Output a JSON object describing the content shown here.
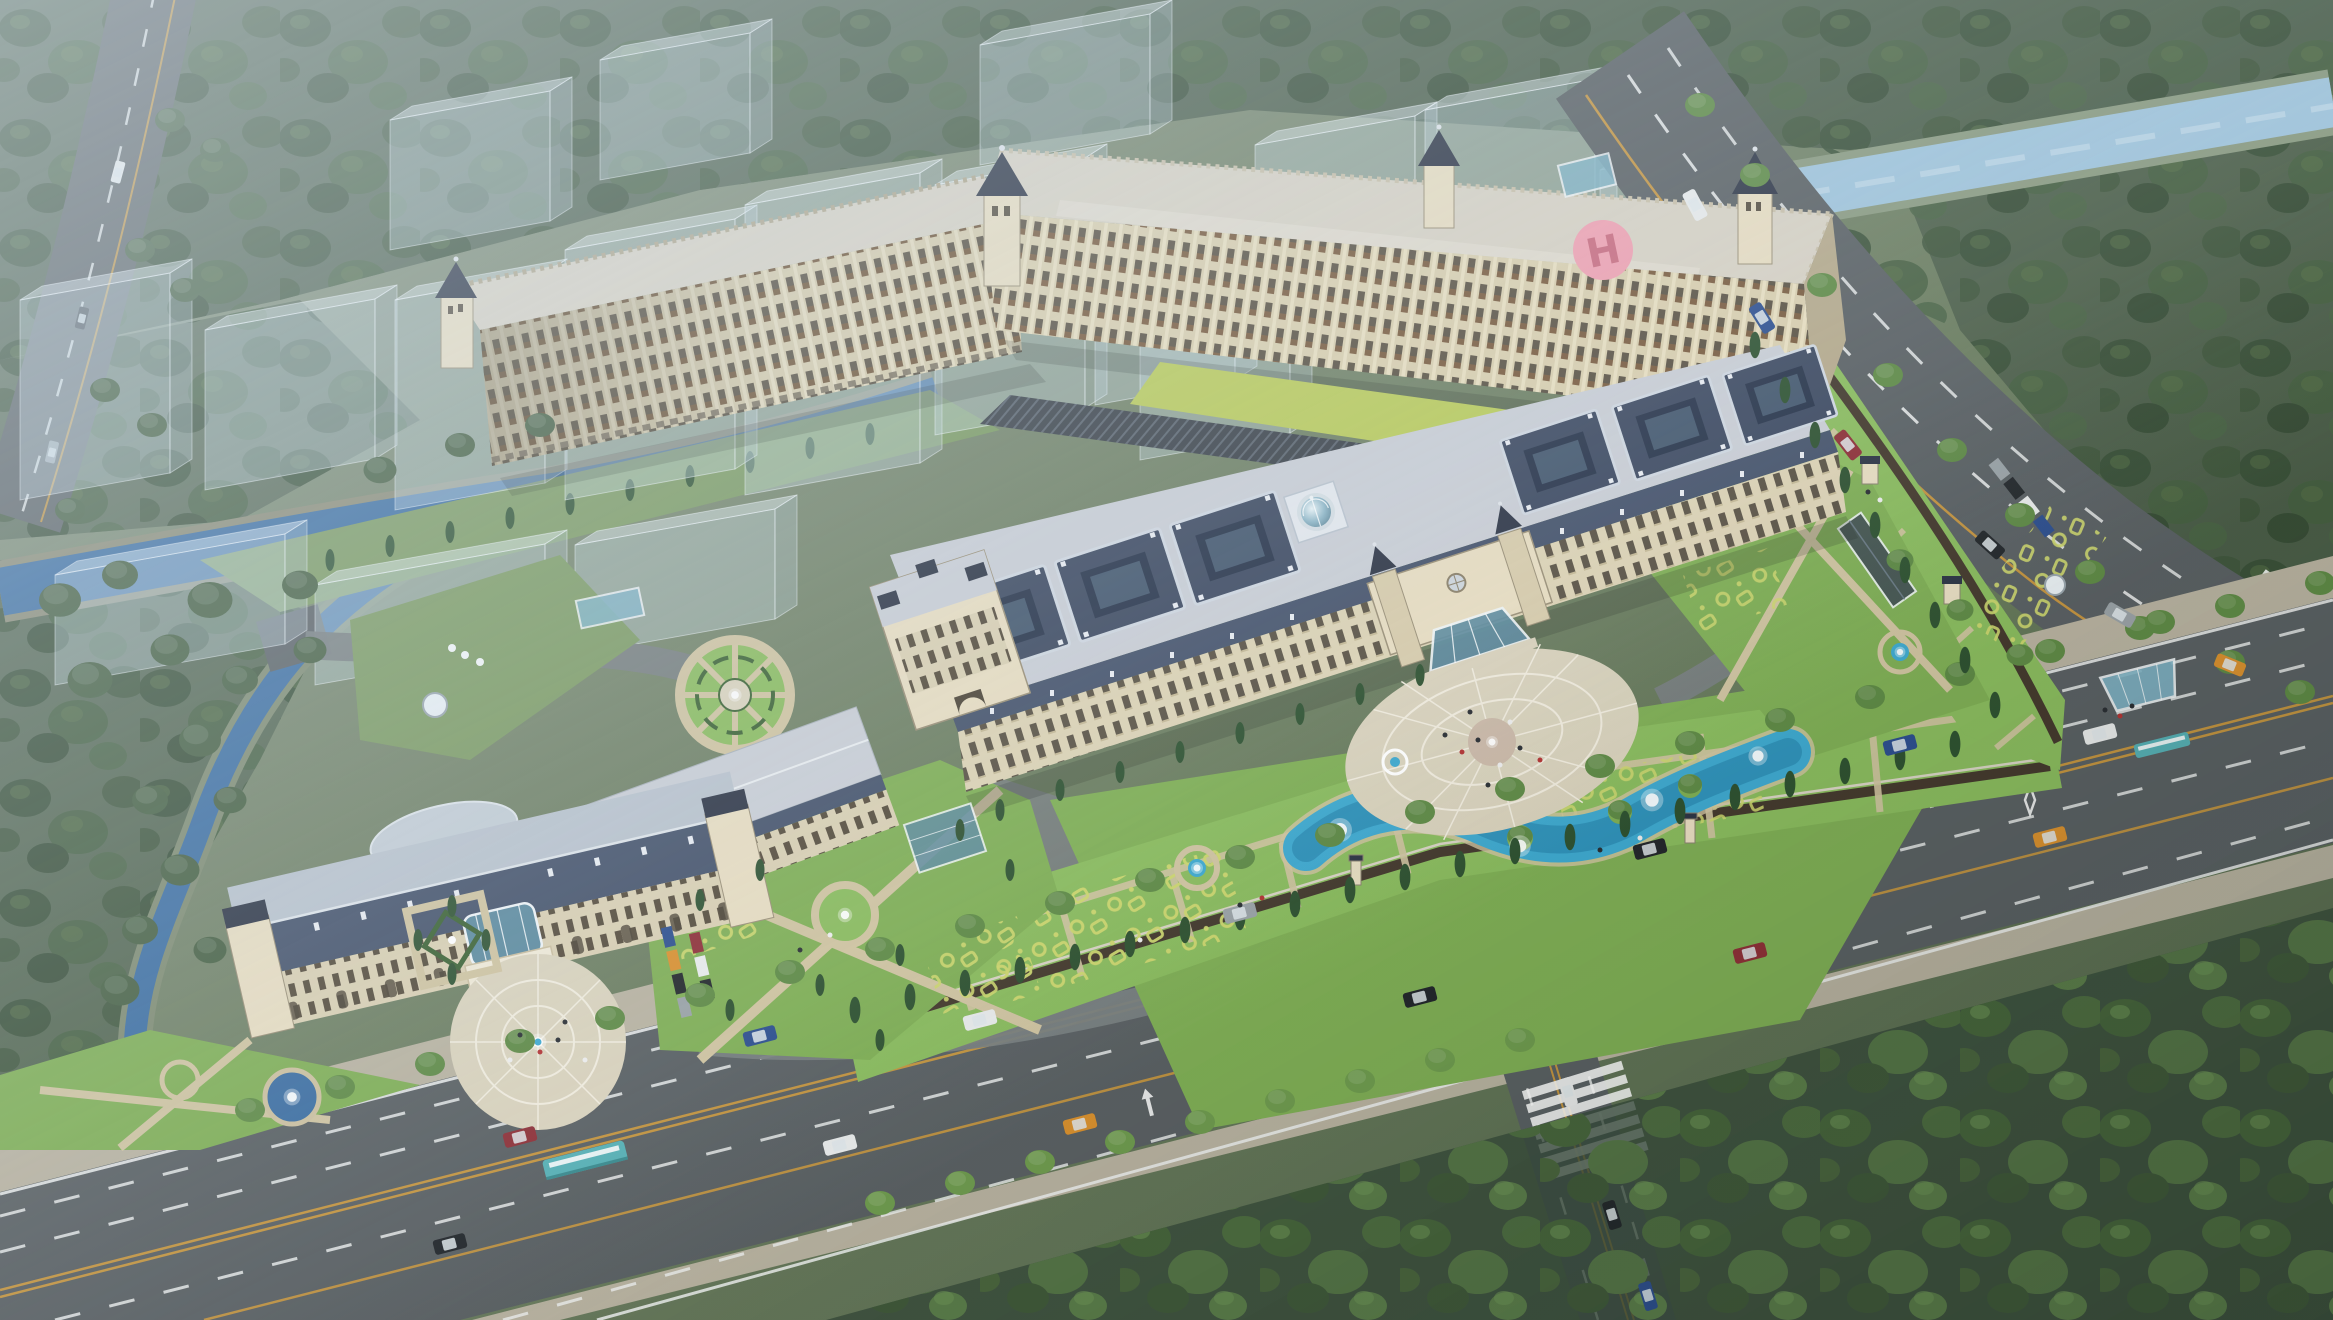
{
  "scene": {
    "helipad_letter": "H"
  },
  "palette": {
    "groundA": "#87927e",
    "groundB": "#697b5c",
    "groundC": "#53664a",
    "forestShadow": "#36493a",
    "forestDark": "#3a5038",
    "forestMid": "#465f41",
    "forestBright": "#4e6b3e",
    "treeAvenue": "#5f8a46",
    "treeLight": "#6f9b4f",
    "cypress": "#2f5231",
    "lawn": "#7fae55",
    "lawnBright": "#8abb5e",
    "lawnMuted": "#7c9a62",
    "hedge": "#3c6233",
    "knotYellow": "#cdd66e",
    "pathTan": "#cfc3a0",
    "plazaStone": "#d9d2bc",
    "plazaLine": "#f0ebdd",
    "asphalt": "#5a6063",
    "asphaltLight": "#787e7f",
    "sidewalk": "#b8b2a0",
    "roadLine": "#eef0ef",
    "roadYellow": "#cf9a3d",
    "canal": "#3c6da0",
    "canalDeep": "#2e5b8c",
    "canalGlint": "#9fc3da",
    "lake": "#3fa9cf",
    "lakeDeep": "#2683ab",
    "facadeCream": "#d7cbab",
    "facadeLight": "#e7dcc0",
    "facadeShade": "#b5a98b",
    "windowDark": "#564d3f",
    "windowAmber": "#8e6038",
    "roofSlab": "#d7d1c3",
    "roofDeck": "#c9cdd4",
    "roofSlate": "#3e4a61",
    "roofSlateLight": "#b9c2cc",
    "mansard": "#46536b",
    "roofDark": "#2e3545",
    "limeRoof": "#b9ca5b",
    "louverDark": "#3b4148",
    "glassTeal": "#7fb2c4",
    "glassDark": "#5d8a9e",
    "frameWhite": "#eef3f5",
    "helipadPink": "#f0a0b0",
    "helipadH": "#c96a7e",
    "ghostFace": "rgba(203,221,234,0.36)",
    "ghostTop": "rgba(231,241,248,0.46)",
    "ghostSide": "rgba(182,201,215,0.32)",
    "ghostEdge": "rgba(248,252,255,0.5)",
    "carWhite": "#e8eaea",
    "carBlack": "#24282c",
    "carRed": "#8e3038",
    "carBlue": "#2e4f8e",
    "carOrange": "#d9902f",
    "carSilver": "#9aa2a6",
    "busTeal": "#57b0b5"
  }
}
